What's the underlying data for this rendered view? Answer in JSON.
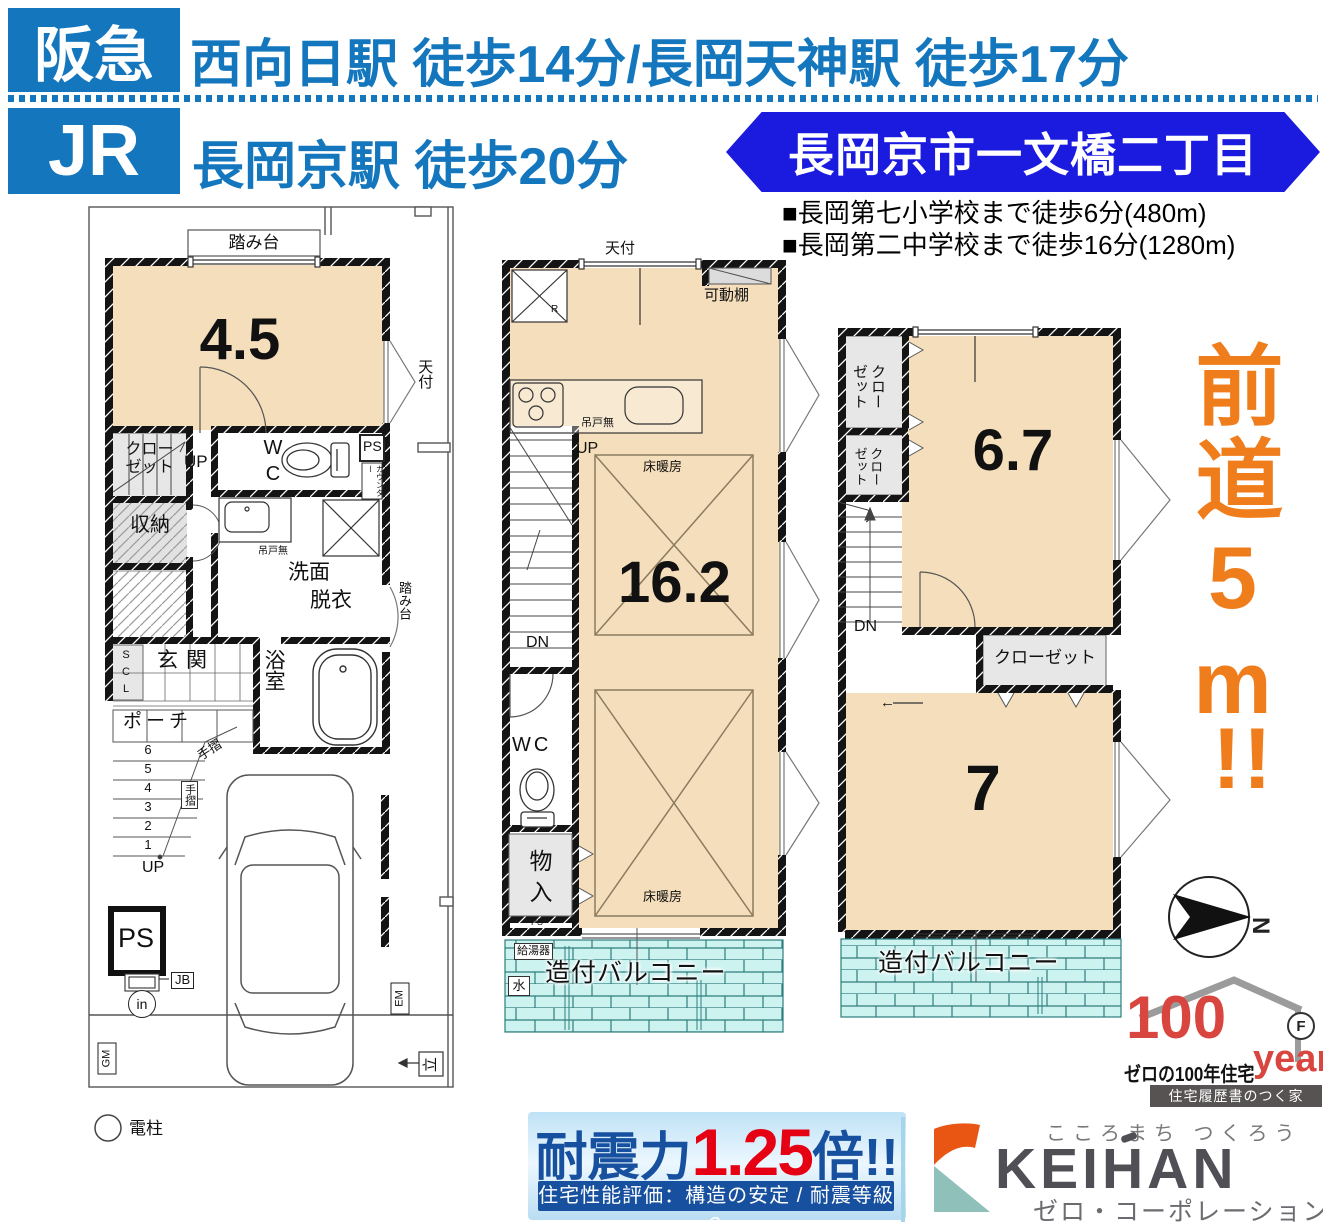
{
  "header": {
    "brand_blue": "#1477bd",
    "banner_blue": "#1b1be0",
    "hankyu": "阪急",
    "hankyu_route": "西向日駅 徒歩14分/長岡天神駅 徒歩17分",
    "jr": "JR",
    "jr_route": "長岡京駅 徒歩20分",
    "address": "長岡京市一文橋二丁目"
  },
  "schools": {
    "elementary": "■長岡第七小学校まで徒歩6分(480m)",
    "junior_high": "■長岡第二中学校まで徒歩16分(1280m)"
  },
  "floor1": {
    "labels": {
      "fumidai_top": "踏み台",
      "size": "4.5",
      "closet": "クロー\nゼット",
      "tenpuke": "天付",
      "up1": "UP",
      "wc": "W\nC",
      "ps_top": "PS",
      "counter": "カウンター",
      "shuno": "収納",
      "tsurido": "吊戸無",
      "senmen1": "洗面",
      "senmen2": "脱衣",
      "fumidai_right": "踏み台",
      "scl": "S\nC\nL",
      "genkan": "玄関",
      "bath": "浴室",
      "porch": "ポーチ",
      "steps": [
        "6",
        "5",
        "4",
        "3",
        "2",
        "1"
      ],
      "tesuri1": "手摺",
      "tesuri2": "手摺",
      "up2": "UP",
      "ps_bottom": "PS",
      "jb": "JB",
      "inlet": "in",
      "gm": "GM",
      "em": "EM",
      "tate": "立",
      "arrow": "←",
      "denchu": "電柱"
    }
  },
  "floor2": {
    "labels": {
      "tenpuke": "天付",
      "kadodana": "可動棚",
      "r": "R",
      "tsurido": "吊戸無",
      "up": "UP",
      "yukadan1": "床暖房",
      "size": "16.2",
      "dn": "DN",
      "wc": "WC",
      "yukadan2": "床暖房",
      "mono": "物\n入",
      "ps": "PS",
      "kyutoki": "給湯器",
      "mizu": "水",
      "balcony": "造付バルコニー"
    }
  },
  "floor3": {
    "labels": {
      "closet1": "クロー\nゼット",
      "closet2": "クロー\nゼット",
      "size1": "6.7",
      "dn": "DN",
      "closet3": "クローゼット",
      "arrow": "←",
      "size2": "7",
      "balcony": "造付バルコニー"
    }
  },
  "road": {
    "text": "前道5m",
    "bang": "!!",
    "color": "#f07d1b"
  },
  "compass": {
    "n": "N"
  },
  "logo100": {
    "hundred": "100",
    "years": "years",
    "f": "F",
    "tagline": "ゼロの100年住宅",
    "bar": "住宅履歴書のつく家",
    "red": "#d9453f"
  },
  "quake": {
    "label": "耐震力",
    "value": "1.25",
    "unit": "倍!!",
    "sub": "住宅性能評価：構造の安定 / 耐震等級２",
    "blue": "#17509f",
    "red": "#e60013"
  },
  "keihan": {
    "tagline": "こころまち つくろう",
    "name": "KEIHAN",
    "sub": "ゼロ・コーポレーション",
    "orange": "#e95513",
    "teal": "#8fc0ba"
  }
}
